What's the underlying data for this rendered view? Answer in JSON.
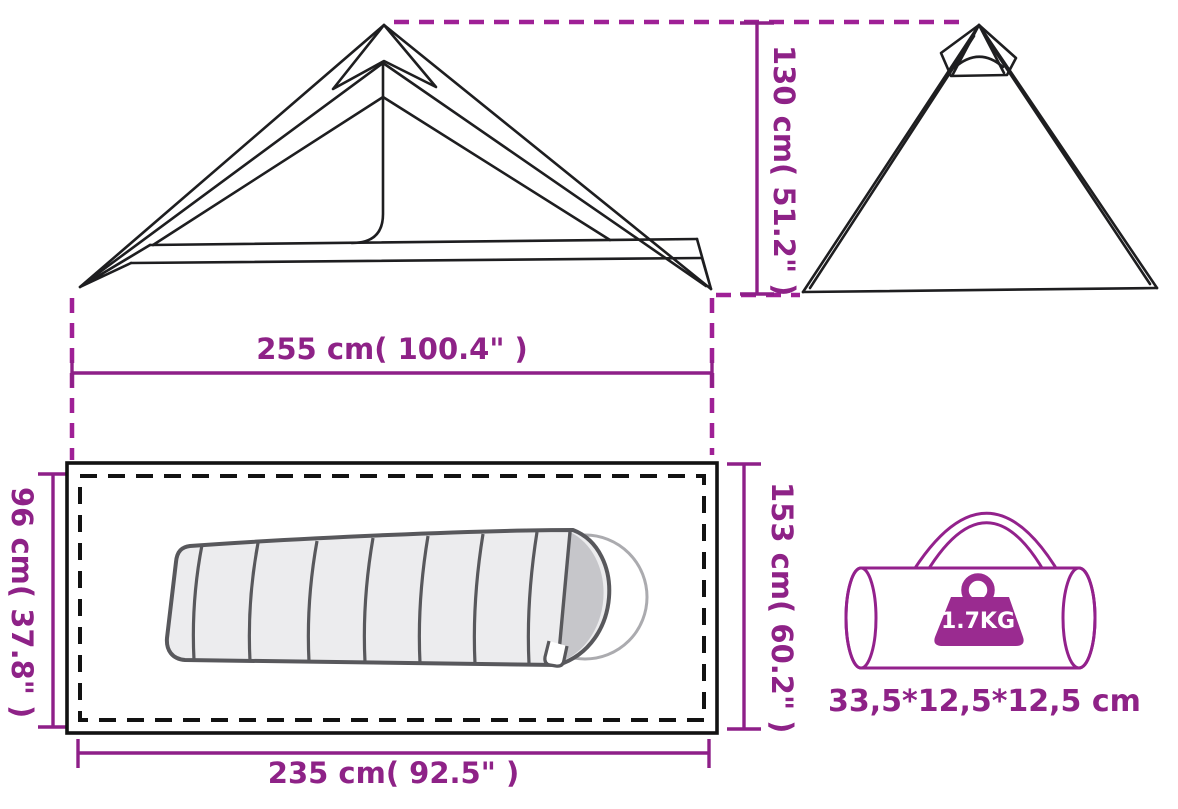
{
  "colors": {
    "accent_text": "#8e2287",
    "dimension_line": "#8e1f88",
    "extension_dash": "#9f2096",
    "line_art": "#1e1e20",
    "bag_outline": "#93218c",
    "weight_badge_fill": "#9a2b90",
    "sleeping_bag_fill": "#ececee",
    "sleeping_bag_outline": "#58585c",
    "sleeping_bag_hood": "#c6c6ca",
    "background": "#ffffff"
  },
  "dimensions": {
    "tent_height": {
      "label": "130 cm( 51.2\" )"
    },
    "tent_width": {
      "label": "255 cm( 100.4\" )"
    },
    "floor_depth": {
      "label": "96 cm( 37.8\" )"
    },
    "floor_side": {
      "label": "153 cm( 60.2\" )"
    },
    "floor_width": {
      "label": "235 cm( 92.5\" )"
    }
  },
  "bag": {
    "weight": "1.7KG",
    "size": "33,5*12,5*12,5 cm"
  },
  "icons": {
    "weight": "weight-kettlebell-icon"
  }
}
